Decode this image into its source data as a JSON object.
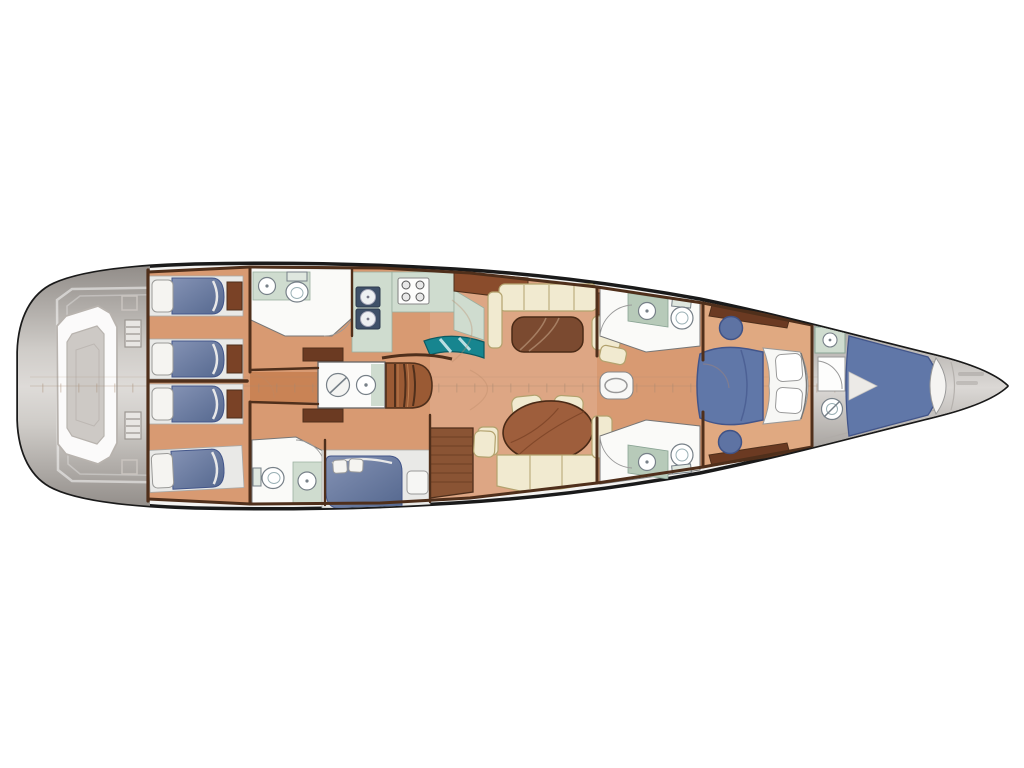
{
  "meta": {
    "title": "Sailing yacht interior deck plan (overhead view, bow pointing right)",
    "orientation": {
      "bow": "right",
      "stern": "left"
    },
    "background": "#ffffff"
  },
  "palette": {
    "hull_outline": "#1a1a1a",
    "deck_white": "#f3f2f0",
    "stern_deck_gray": "#9b9692",
    "bow_deck_gray": "#aaa6a2",
    "floor_salmon": "#d89a72",
    "floor_salon": "#dda684",
    "corridor_brown": "#b5713f",
    "wall_brown": "#4f2f1b",
    "wood_furniture": "#8a4c2c",
    "table_brown": "#7b4a30",
    "berth_blue": "#64779f",
    "berth_blue_dark": "#42558a",
    "cream_upholstery": "#f1ead0",
    "cream_trim": "#b3a26e",
    "head_white": "#fafaf8",
    "counter_sage": "#cfdccf",
    "counter_sage_dark": "#b7cab9",
    "chart_teal": "#17858f",
    "fixture_stroke": "#778088",
    "ruler_tan": "#a58870"
  },
  "areas": [
    {
      "id": "stern-lazarette",
      "label": "Stern deck / lazarette",
      "features": [
        "stowed dinghy (nested tube outline)",
        "deck hatch outline",
        "two boarding ladders",
        "two deck fittings"
      ]
    },
    {
      "id": "aft-cabin-port",
      "label": "Aft cabin port",
      "features": [
        "single berth with pillow",
        "single berth with pillow",
        "foot shelf"
      ]
    },
    {
      "id": "aft-cabin-starboard",
      "label": "Aft cabin starboard",
      "features": [
        "single berth with pillow",
        "single berth with pillow",
        "foot shelf"
      ]
    },
    {
      "id": "aft-head-port",
      "label": "Aft head (port)",
      "features": [
        "washbasin",
        "toilet",
        "door swing"
      ]
    },
    {
      "id": "aft-head-starboard",
      "label": "Aft head (starboard)",
      "features": [
        "washbasin",
        "toilet",
        "door swing"
      ]
    },
    {
      "id": "day-head",
      "label": "Amidships day head",
      "features": [
        "shower fixture",
        "washbasin"
      ]
    },
    {
      "id": "companionway",
      "label": "Companionway steps",
      "features": [
        "curved stair treads"
      ]
    },
    {
      "id": "galley",
      "label": "Galley",
      "features": [
        "double sink",
        "four-burner stove",
        "L-counters",
        "teal chart/instrument surface",
        "top lockers"
      ]
    },
    {
      "id": "salon",
      "label": "Salon",
      "features": [
        "L-settee with cushions",
        "coffee table",
        "sideboard",
        "oval dining table",
        "two chairs",
        "U-shaped dinette bench"
      ]
    },
    {
      "id": "nav-vanity",
      "label": "Desk / vanity with seat",
      "features": [
        "wood desk",
        "cream seat"
      ]
    },
    {
      "id": "guest-cabin-mid",
      "label": "Midship guest cabin (starboard)",
      "features": [
        "double berth",
        "two pillows",
        "nightstand"
      ]
    },
    {
      "id": "fwd-head-port",
      "label": "Forward head (port)",
      "features": [
        "washbasin on counter",
        "toilet"
      ]
    },
    {
      "id": "fwd-head-starboard",
      "label": "Forward head (starboard)",
      "features": [
        "washbasin on counter",
        "toilet"
      ]
    },
    {
      "id": "mast-step",
      "label": "Mast step on centerline",
      "features": [
        "oval mast section"
      ]
    },
    {
      "id": "owner-cabin",
      "label": "Owner cabin forward",
      "features": [
        "island double bed",
        "two pillows",
        "two round ottomans",
        "angled wardrobes"
      ]
    },
    {
      "id": "crew-bow-area",
      "label": "Crew / sail area in bow",
      "features": [
        "sink cabinet",
        "corner shower",
        "toilet",
        "tapered V-berth",
        "bolster cushion"
      ]
    },
    {
      "id": "bow-locker",
      "label": "Bow locker tip",
      "features": [
        "faint stencil marks (illegible)"
      ]
    },
    {
      "id": "centerline-ruler",
      "label": "Faint centerline station ruler",
      "features": [
        "tick marks along hull centerline"
      ]
    }
  ]
}
